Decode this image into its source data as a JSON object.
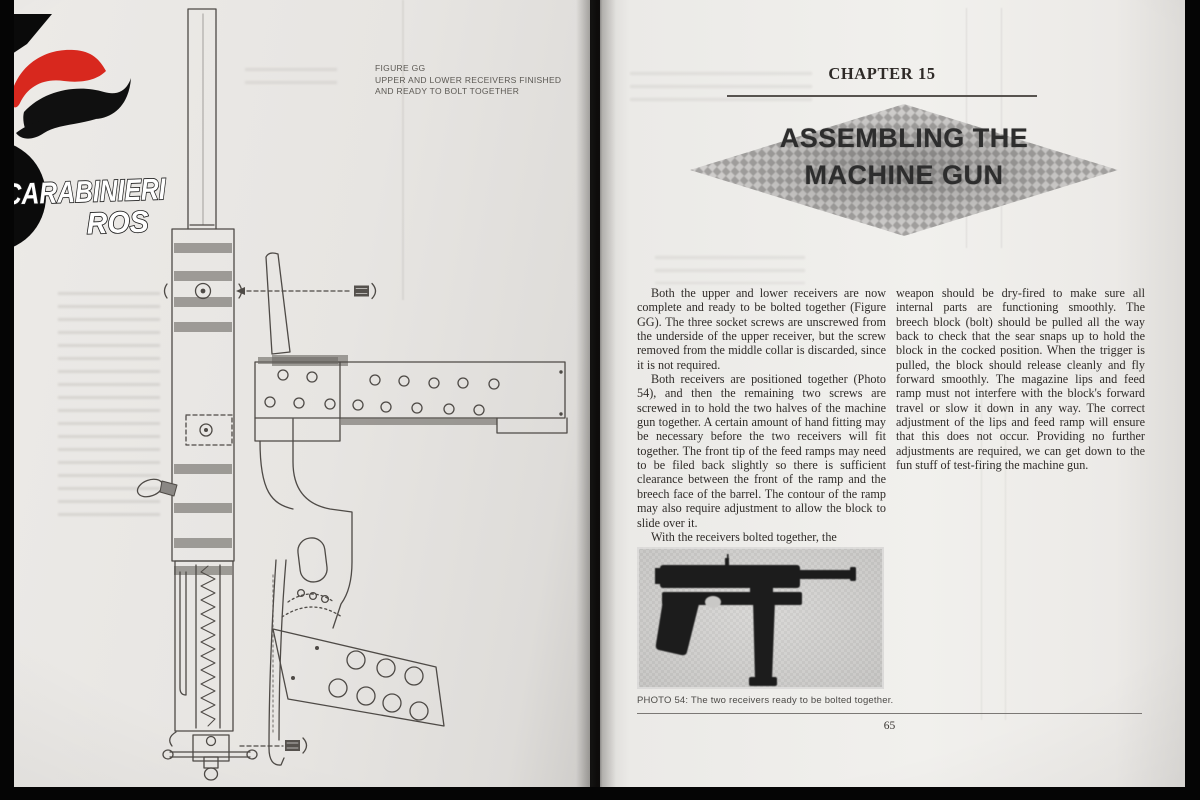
{
  "logo": {
    "line1": "CARABINIERI",
    "line2": "ROS",
    "flame_red": "#d8281e",
    "flame_black": "#101010"
  },
  "left_page": {
    "figure_caption_line1": "FIGURE GG",
    "figure_caption_line2": "UPPER AND LOWER RECEIVERS FINISHED",
    "figure_caption_line3": "AND READY TO BOLT TOGETHER"
  },
  "right_page": {
    "chapter_label": "CHAPTER 15",
    "title_line1": "ASSEMBLING THE",
    "title_line2": "MACHINE GUN",
    "body": {
      "col1_p1": "Both the upper and lower receivers are now complete and ready to be bolted together (Figure GG). The three socket screws are unscrewed from the underside of the upper receiver, but the screw removed from the middle collar is discarded, since it is not required.",
      "col1_p2": "Both receivers are positioned together (Photo 54), and then the remaining two screws are screwed in to hold the two halves of the machine gun together. A certain amount of hand fitting may be necessary before the two receivers will fit together. The front tip of the feed ramps may need to be filed back slightly so there is sufficient clearance between the front of the ramp and the breech face of the barrel. The contour of the ramp may also require adjustment to allow the block to slide over it.",
      "col1_p3": "With the receivers bolted together, the",
      "col2_p1": "weapon should be dry-fired to make sure all internal parts are functioning smoothly. The breech block (bolt) should be pulled all the way back to check that the sear snaps up to hold the block in the cocked position. When the trigger is pulled, the block should release cleanly and fly forward smoothly. The magazine lips and feed ramp must not interfere with the block's forward travel or slow it down in any way. The correct adjustment of the lips and feed ramp will ensure that this does not occur. Providing no further adjustments are required, we can get down to the fun stuff of test-firing the machine gun."
    },
    "photo_caption": "PHOTO 54: The two receivers ready to be bolted together.",
    "page_number": "65"
  }
}
